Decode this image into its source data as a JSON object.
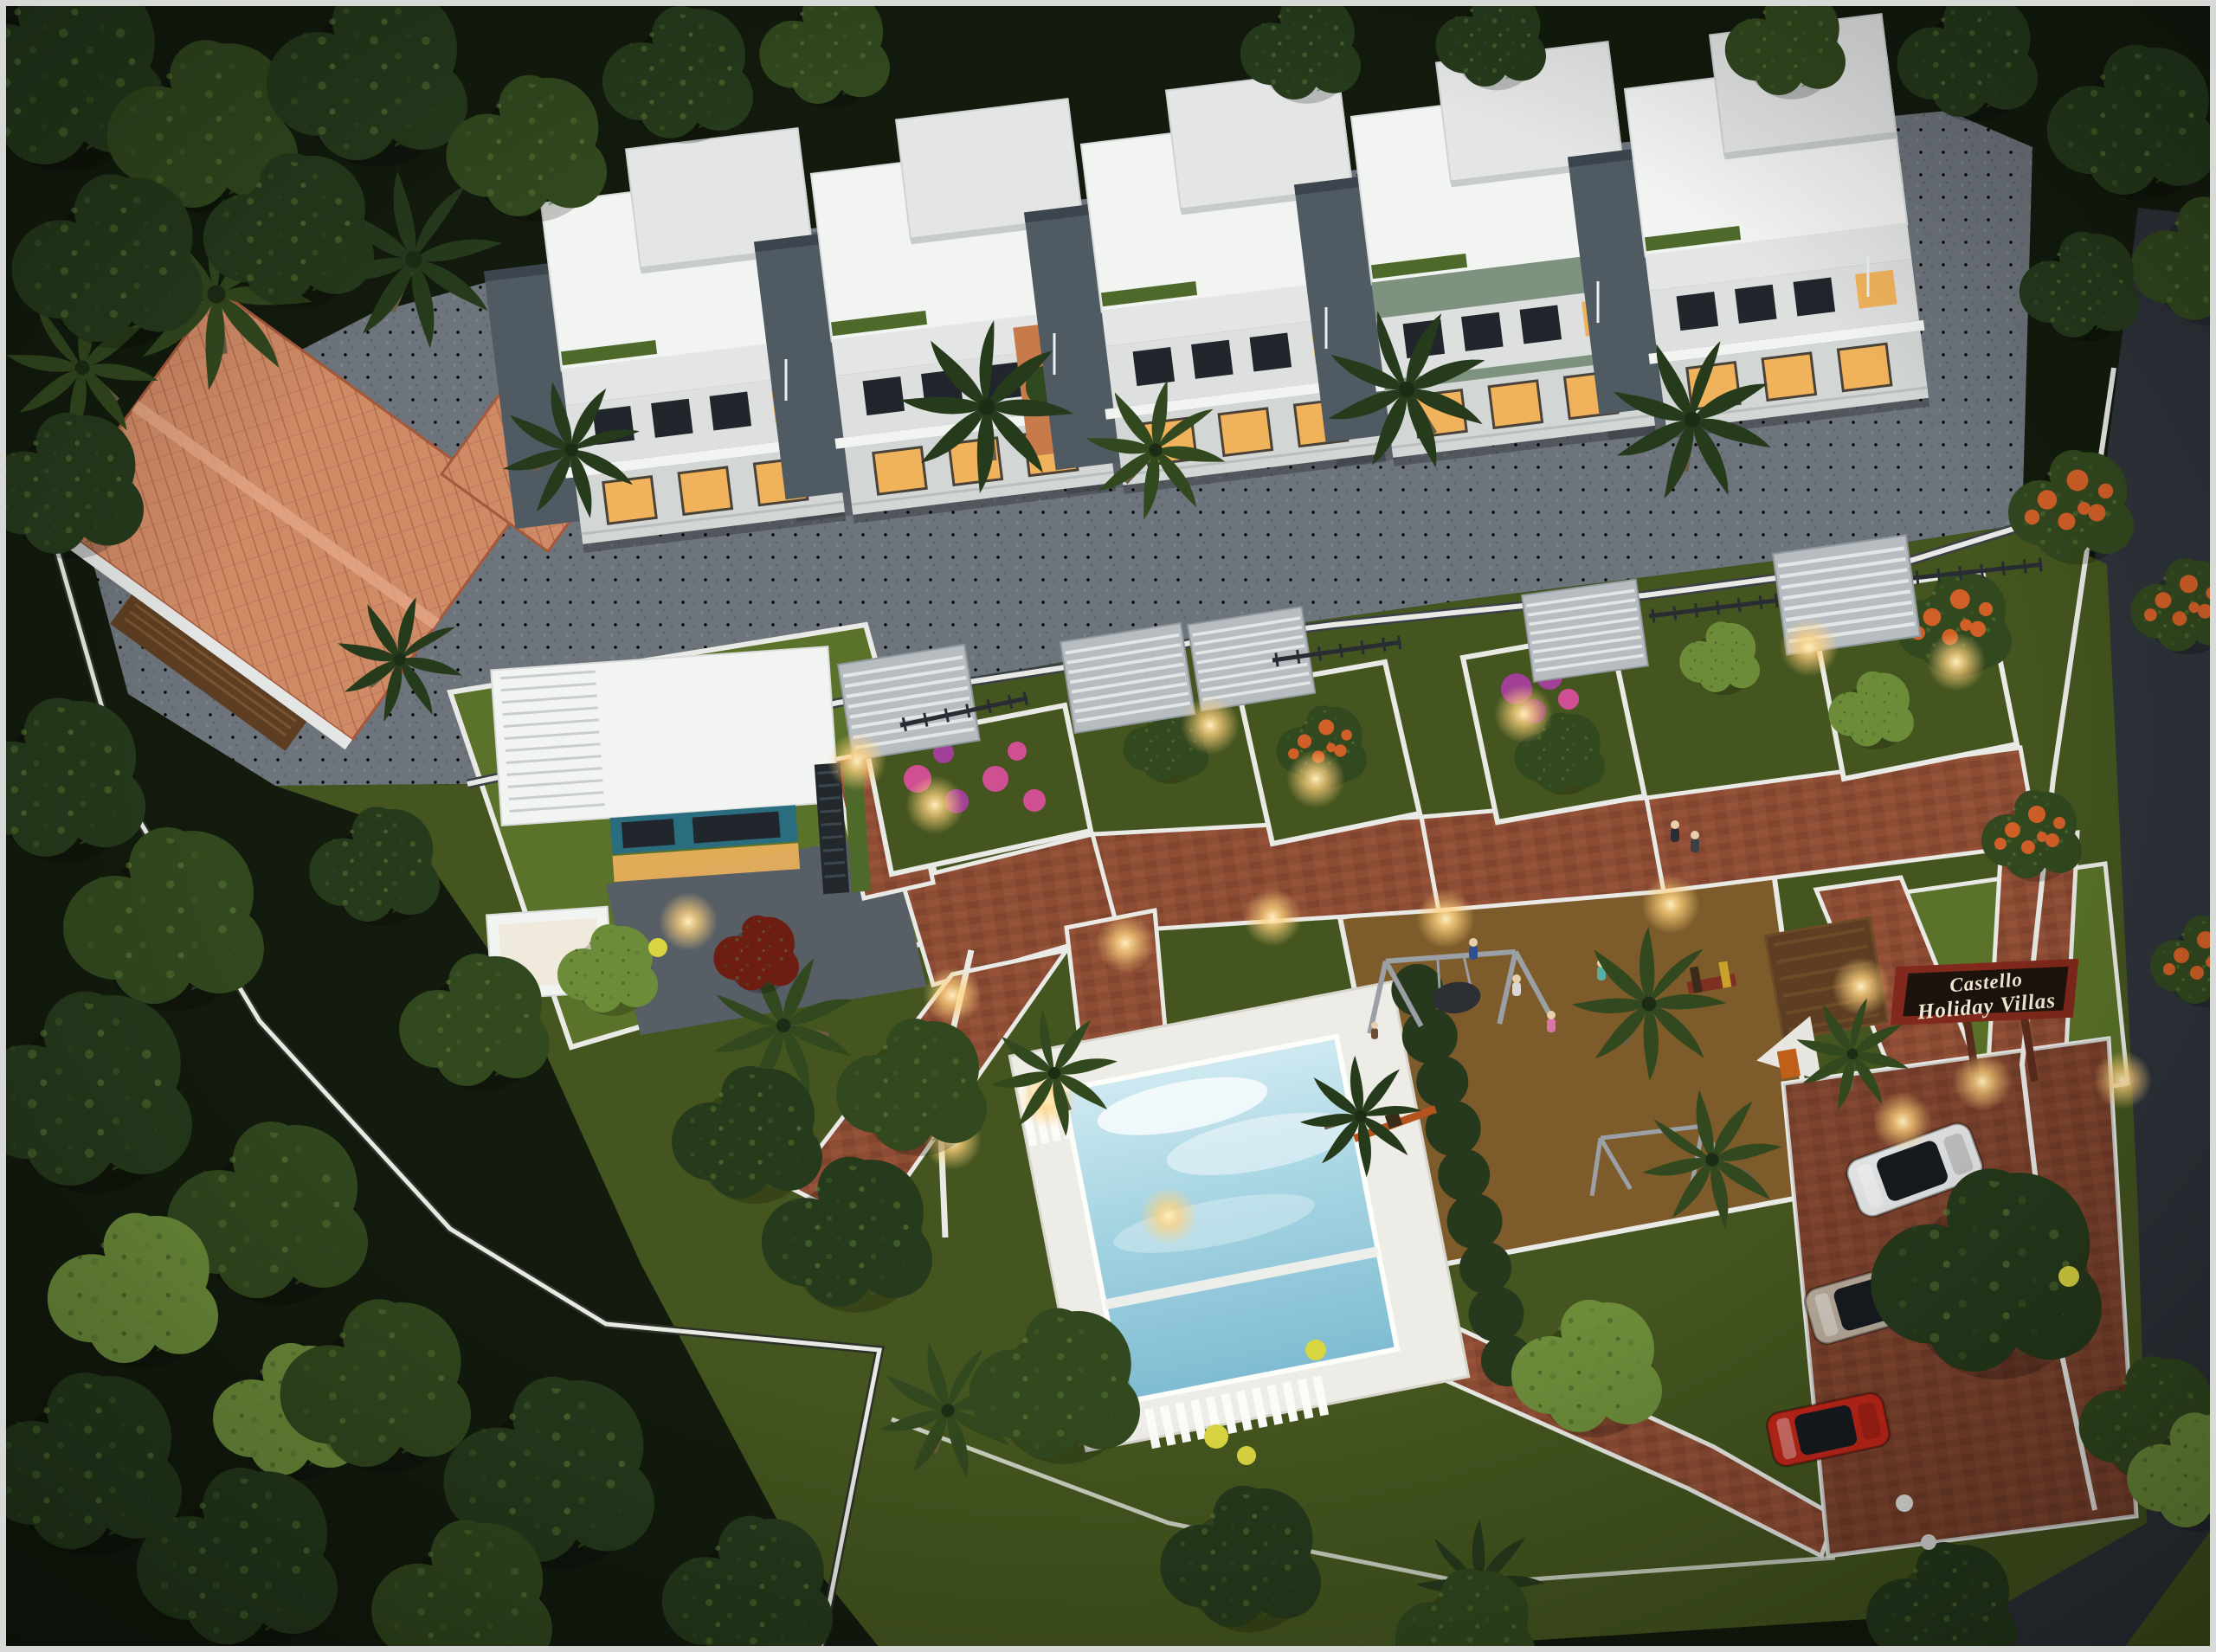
{
  "scene": {
    "title": "Castello Holiday Villas",
    "description": "Dusk aerial 3D render of a gated holiday-villa resort on terraced ground surrounded by forest",
    "top_row_villa_count": 5,
    "buildings": [
      "five white flat-roof villas in a row",
      "traditional terracotta tiled-roof villa",
      "detached modern pool villa",
      "timber gazebo"
    ],
    "amenities": [
      "swimming pool with white deck",
      "children's playground with swings",
      "landscaped brick-paved courtyard with lit planters",
      "parking court",
      "entry signboard",
      "asphalt access road"
    ],
    "vehicles": [
      {
        "type": "car",
        "color": "white"
      },
      {
        "type": "car",
        "color": "silver"
      },
      {
        "type": "car",
        "color": "red"
      }
    ]
  },
  "signboard": {
    "line1": "Castello",
    "line2": "Holiday Villas"
  },
  "palette": {
    "forest_dark": "#131b0e",
    "canopy": "#263a1c",
    "canopy_mid": "#32481f",
    "canopy_light": "#4e6a2a",
    "accent_tree": "#6c8c3a",
    "lawn": "#44551f",
    "lawn_bright": "#5a7229",
    "pavement": "#6d747b",
    "pavement_dark": "#575e65",
    "road": "#2e333a",
    "villa_white": "#f2f4f2",
    "villa_offwhite": "#e3e6e4",
    "villa_gray": "#4f5a63",
    "glass_dark": "#20262c",
    "window_warm": "#f0b35c",
    "wall_white": "#e9eae5",
    "tile": "#cf8a66",
    "tile_dark": "#b06c4b",
    "wood": "#5d3e22",
    "brick": "#8d4c34",
    "brick_dark": "#76402b",
    "brick_light": "#a05a3e",
    "play_surface": "#7d5b2a",
    "pool_deck": "#edece6",
    "water_light": "#cfe9f1",
    "water_deep": "#7fbcd2",
    "hedge": "#26391d",
    "sign_frame": "#80291c",
    "sign_panel": "#1d130d",
    "sign_text": "#f2e8d5",
    "car_white": "#e2e4e5",
    "car_silver": "#b9ac9c",
    "car_red": "#c2271a",
    "flower_pink": "#cf4f92",
    "flower_magenta": "#a23f96",
    "flower_orange": "#d05f28",
    "flower_yellow": "#d9d441",
    "frame_border": "#d8dad7"
  }
}
